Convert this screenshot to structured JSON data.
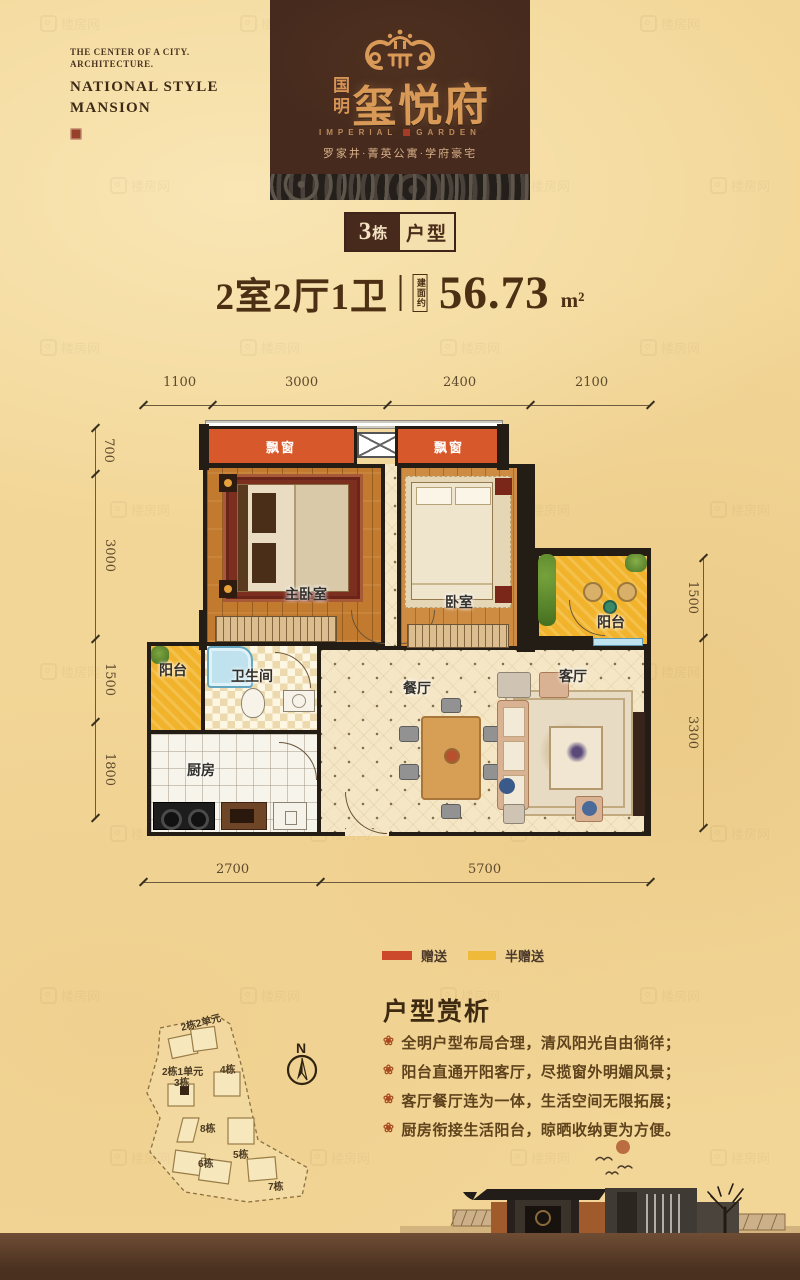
{
  "watermark": {
    "text": "楼房网"
  },
  "top_left": {
    "line1": "THE CENTER OF A CITY.",
    "line2": "ARCHITECTURE.",
    "line3": "NATIONAL STYLE",
    "line4": "MANSION"
  },
  "banner": {
    "brand_cn_side": "国明",
    "brand_cn_main": "玺悦府",
    "brand_en_left": "IMPERIAL",
    "brand_en_right": "GARDEN",
    "tagline": "罗家井·菁英公寓·学府豪宅"
  },
  "badge": {
    "building_num": "3",
    "building_suffix": "栋",
    "label": "户型"
  },
  "spec": {
    "layout": "2室2厅1卫",
    "area_prefix": "建面约",
    "area_value": "56.73",
    "area_unit": "m²"
  },
  "plan": {
    "dims_top": [
      "1100",
      "3000",
      "2400",
      "2100"
    ],
    "dims_left": [
      "700",
      "3000",
      "1500",
      "1800"
    ],
    "dims_right": [
      "1500",
      "3300"
    ],
    "dims_bottom": [
      "2700",
      "5700"
    ],
    "labels": {
      "bay1": "飘窗",
      "bay2": "飘窗",
      "master_bedroom": "主卧室",
      "bedroom": "卧室",
      "balcony_right": "阳台",
      "balcony_left": "阳台",
      "bathroom": "卫生间",
      "kitchen": "厨房",
      "dining": "餐厅",
      "living": "客厅"
    }
  },
  "legend": {
    "items": [
      {
        "label": "赠送",
        "color": "#cc4a2b"
      },
      {
        "label": "半赠送",
        "color": "#efba3a"
      }
    ]
  },
  "siteplan": {
    "compass": "N",
    "labels": [
      "2栋2单元",
      "2栋1单元",
      "3栋",
      "4栋",
      "8栋",
      "5栋",
      "6栋",
      "7栋"
    ]
  },
  "analysis": {
    "title": "户型赏析",
    "bullet_icon": "❀",
    "bullets": [
      "全明户型布局合理，清风阳光自由徜徉；",
      "阳台直通开阳客厅，尽揽窗外明媚风景；",
      "客厅餐厅连为一体，生活空间无限拓展；",
      "厨房衔接生活阳台，晾晒收纳更为方便。"
    ]
  },
  "colors": {
    "accent_red": "#cc4a2b",
    "accent_yellow": "#efba3a",
    "brand_gold": "#d99a58",
    "banner_brown": "#452a1d"
  }
}
